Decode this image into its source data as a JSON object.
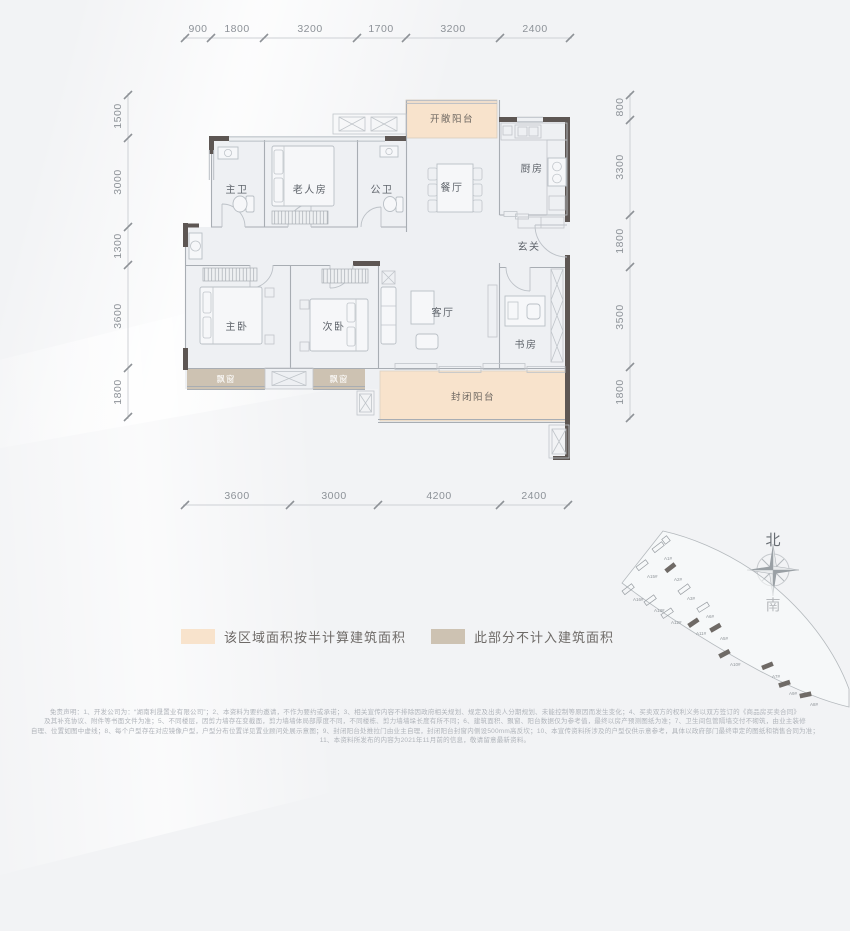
{
  "dimensions": {
    "top": [
      "900",
      "1800",
      "3200",
      "1700",
      "3200",
      "2400"
    ],
    "bottom": [
      "3600",
      "3000",
      "4200",
      "2400"
    ],
    "left": [
      "1500",
      "3000",
      "1300",
      "3600",
      "1800"
    ],
    "right": [
      "800",
      "3300",
      "1800",
      "3500",
      "1800"
    ]
  },
  "rooms": {
    "master_bath": "主卫",
    "elder_room": "老人房",
    "public_bath": "公卫",
    "dining": "餐厅",
    "kitchen": "厨房",
    "open_balcony": "开敞阳台",
    "foyer": "玄关",
    "master_bedroom": "主卧",
    "second_bedroom": "次卧",
    "living_room": "客厅",
    "study": "书房",
    "bay_window": "飘窗",
    "enclosed_balcony": "封闭阳台"
  },
  "legend": {
    "half_area_label": "该区域面积按半计算建筑面积",
    "half_area_color": "#f8e3cc",
    "excluded_label": "此部分不计入建筑面积",
    "excluded_color": "#cdc2b2"
  },
  "compass": {
    "north": "北",
    "south": "南"
  },
  "site_map": {
    "buildings": [
      "A1#",
      "A15#",
      "A2#",
      "A16#",
      "A13#",
      "A3#",
      "A12#",
      "A11#",
      "A6#",
      "A5#",
      "A10#",
      "A7#",
      "A9#",
      "A8#"
    ]
  },
  "disclaimer": {
    "lines": [
      "免责声明：1、开发公司为：“湖南利晟置业有限公司”；2、本资料为要约邀请，不作为要约或承诺；3、相关宣传内容不排除因政府相关规划、规定及出卖人分期规划、未能控制等原因而发生变化；4、买卖双方的权利义务以双方签订的《商品房买卖合同》",
      "及其补充协议、附件等书面文件为准；5、不同楼层，因剪力墙存在变截面，剪力墙墙体局部厚度不同，不同楼栋、剪力墙墙垛长度有所不同；6、建筑面积、飘窗、阳台数据仅为参考值，最终以房产预测图纸为准；7、卫生间包管隔墙交付不砌筑，由业主装修",
      "自理、位置如图中虚线；8、每个户型存在对应镜像户型，户型分布位置详见置业顾问处展示意图；9、封闭阳台处推拉门由业主自理，封闭阳台封窗内侧设500mm高反坎；10、本宣传资料所涉及的户型仅供示意参考，具体以政府部门最终审定的图纸和销售合同为准；",
      "11、本资料所发布的内容为2021年11月前的信息，敬请留意最新资料。"
    ]
  },
  "colors": {
    "wall": "#5d5653",
    "half_area_fill": "#f8e3cc",
    "excluded_fill": "#cdc2b2",
    "background": "#f2f3f5"
  }
}
